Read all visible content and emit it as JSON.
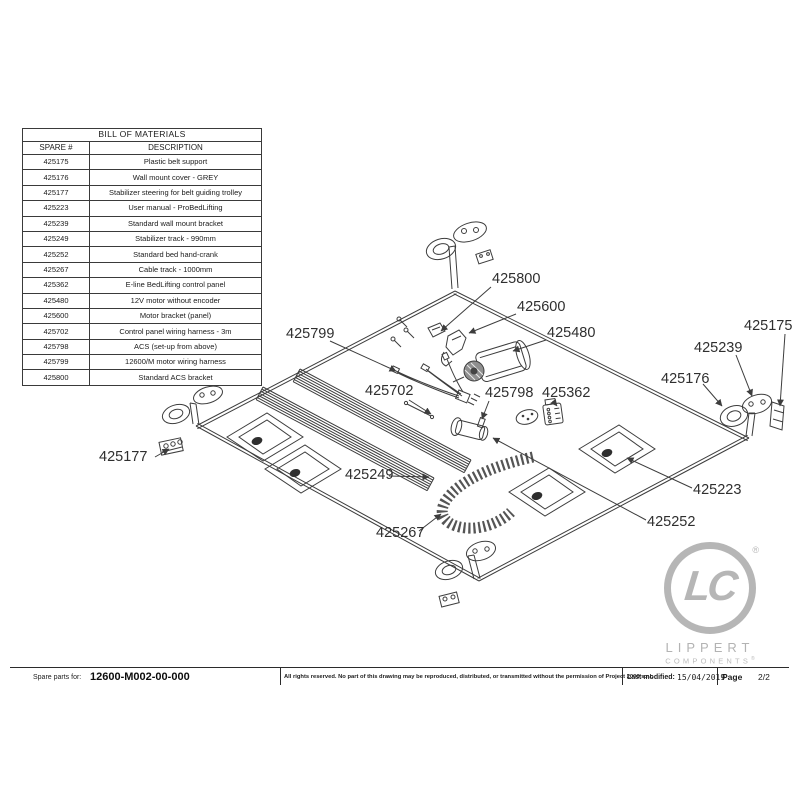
{
  "bom": {
    "title": "BILL OF MATERIALS",
    "columns": [
      "SPARE #",
      "DESCRIPTION"
    ],
    "rows": [
      {
        "spare": "425175",
        "desc": "Plastic belt support"
      },
      {
        "spare": "425176",
        "desc": "Wall mount cover - GREY"
      },
      {
        "spare": "425177",
        "desc": "Stabilizer steering for belt guiding trolley"
      },
      {
        "spare": "425223",
        "desc": "User manual - ProBedLifting"
      },
      {
        "spare": "425239",
        "desc": "Standard wall mount bracket"
      },
      {
        "spare": "425249",
        "desc": "Stabilizer track - 990mm"
      },
      {
        "spare": "425252",
        "desc": "Standard bed hand-crank"
      },
      {
        "spare": "425267",
        "desc": "Cable track - 1000mm"
      },
      {
        "spare": "425362",
        "desc": "E-line BedLifting control panel"
      },
      {
        "spare": "425480",
        "desc": "12V motor without encoder"
      },
      {
        "spare": "425600",
        "desc": "Motor bracket (panel)"
      },
      {
        "spare": "425702",
        "desc": "Control panel wiring harness - 3m"
      },
      {
        "spare": "425798",
        "desc": "ACS (set-up from above)"
      },
      {
        "spare": "425799",
        "desc": "12600/M motor wiring harness"
      },
      {
        "spare": "425800",
        "desc": "Standard ACS bracket"
      }
    ]
  },
  "diagram": {
    "labels": [
      {
        "text": "425800"
      },
      {
        "text": "425600"
      },
      {
        "text": "425480"
      },
      {
        "text": "425799"
      },
      {
        "text": "425702"
      },
      {
        "text": "425798"
      },
      {
        "text": "425362"
      },
      {
        "text": "425175"
      },
      {
        "text": "425239"
      },
      {
        "text": "425176"
      },
      {
        "text": "425177"
      },
      {
        "text": "425249"
      },
      {
        "text": "425267"
      },
      {
        "text": "425223"
      },
      {
        "text": "425252"
      }
    ],
    "line_color": "#3d3d3d",
    "label_color": "#2f2f2f"
  },
  "logo": {
    "monogram": "LC",
    "name": "LIPPERT",
    "subname": "COMPONENTS",
    "registered": "®",
    "gray": "#b6b6b6"
  },
  "footer": {
    "spare_parts_label": "Spare parts for:",
    "part_number": "12600-M002-00-000",
    "copyright": "All rights reserved. No part of this drawing may be reproduced, distributed, or transmitted without the permission of Project 2000 s.r.l.",
    "last_modified_label": "Last modified:",
    "last_modified_date": "15/04/2019",
    "page_label": "Page",
    "page_value": "2/2"
  }
}
